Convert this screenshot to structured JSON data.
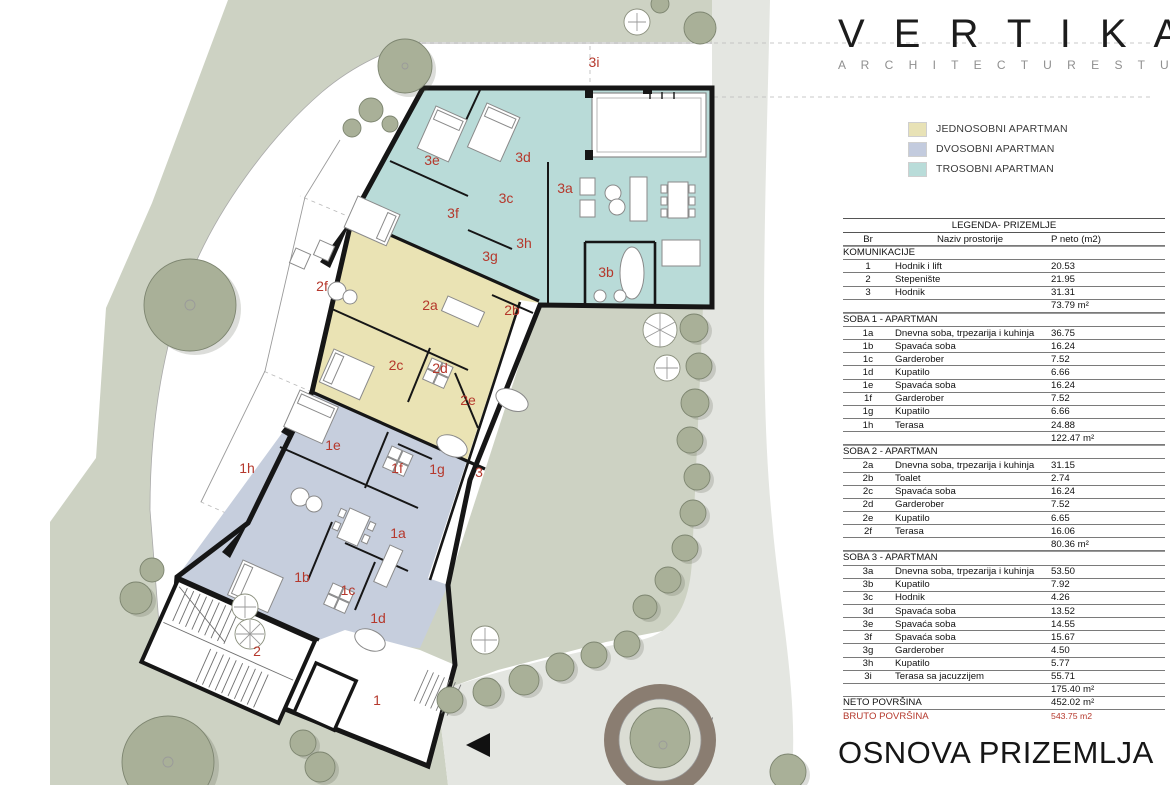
{
  "brand": {
    "name": "VERTIKALA",
    "display": "V E R T I K A L Λ",
    "subtitle": "A R C H I T E C T U R E   S T U D I O"
  },
  "legend": {
    "items": [
      {
        "label": "JEDNOSOBNI APARTMAN",
        "color": "#e8e2b6"
      },
      {
        "label": "DVOSOBNI APARTMAN",
        "color": "#c3cbde"
      },
      {
        "label": "TROSOBNI APARTMAN",
        "color": "#b9dcd9"
      }
    ]
  },
  "table": {
    "title": "LEGENDA- PRIZEMLJE",
    "columns": [
      "Br",
      "Naziv prostorije",
      "P neto (m2)"
    ],
    "sections": [
      {
        "name": "KOMUNIKACIJE",
        "rows": [
          [
            "1",
            "Hodnik i lift",
            "20.53"
          ],
          [
            "2",
            "Stepenište",
            "21.95"
          ],
          [
            "3",
            "Hodnik",
            "31.31"
          ]
        ],
        "subtotal": "73.79 m²"
      },
      {
        "name": "SOBA 1 - APARTMAN",
        "rows": [
          [
            "1a",
            "Dnevna soba, trpezarija i kuhinja",
            "36.75"
          ],
          [
            "1b",
            "Spavaća soba",
            "16.24"
          ],
          [
            "1c",
            "Garderober",
            "7.52"
          ],
          [
            "1d",
            "Kupatilo",
            "6.66"
          ],
          [
            "1e",
            "Spavaća soba",
            "16.24"
          ],
          [
            "1f",
            "Garderober",
            "7.52"
          ],
          [
            "1g",
            "Kupatilo",
            "6.66"
          ],
          [
            "1h",
            "Terasa",
            "24.88"
          ]
        ],
        "subtotal": "122.47 m²"
      },
      {
        "name": "SOBA 2 - APARTMAN",
        "rows": [
          [
            "2a",
            "Dnevna soba, trpezarija i kuhinja",
            "31.15"
          ],
          [
            "2b",
            "Toalet",
            "2.74"
          ],
          [
            "2c",
            "Spavaća soba",
            "16.24"
          ],
          [
            "2d",
            "Garderober",
            "7.52"
          ],
          [
            "2e",
            "Kupatilo",
            "6.65"
          ],
          [
            "2f",
            "Terasa",
            "16.06"
          ]
        ],
        "subtotal": "80.36 m²"
      },
      {
        "name": "SOBA 3 - APARTMAN",
        "rows": [
          [
            "3a",
            "Dnevna soba, trpezarija i kuhinja",
            "53.50"
          ],
          [
            "3b",
            "Kupatilo",
            "7.92"
          ],
          [
            "3c",
            "Hodnik",
            "4.26"
          ],
          [
            "3d",
            "Spavaća soba",
            "13.52"
          ],
          [
            "3e",
            "Spavaća soba",
            "14.55"
          ],
          [
            "3f",
            "Spavaća soba",
            "15.67"
          ],
          [
            "3g",
            "Garderober",
            "4.50"
          ],
          [
            "3h",
            "Kupatilo",
            "5.77"
          ],
          [
            "3i",
            "Terasa sa jacuzzijem",
            "55.71"
          ]
        ],
        "subtotal": "175.40 m²"
      }
    ],
    "totals": [
      {
        "label": "NETO POVRŠINA",
        "value": "452.02 m²",
        "style": "neto"
      },
      {
        "label": "BRUTO POVRŠINA",
        "value": "543.75 m2",
        "style": "bruto"
      }
    ]
  },
  "plan": {
    "title": "OSNOVA PRIZEMLJA",
    "label_color": "#b5382c",
    "colors": {
      "site": "#cdd2c3",
      "pavement": "#e4e6e1",
      "walkway": "#ffffff",
      "apartment1": "#c6cedd",
      "apartment2": "#eae3b4",
      "apartment3": "#b9dbd8",
      "wall": "#161616",
      "tree": "#a9b098",
      "planter_ring": "#8a7d71"
    },
    "rooms": [
      {
        "id": "3i",
        "x": 594,
        "y": 67
      },
      {
        "id": "3e",
        "x": 432,
        "y": 165
      },
      {
        "id": "3d",
        "x": 523,
        "y": 162
      },
      {
        "id": "3c",
        "x": 506,
        "y": 203
      },
      {
        "id": "3a",
        "x": 565,
        "y": 193
      },
      {
        "id": "3f",
        "x": 453,
        "y": 218
      },
      {
        "id": "3g",
        "x": 490,
        "y": 261
      },
      {
        "id": "3h",
        "x": 524,
        "y": 248
      },
      {
        "id": "3b",
        "x": 606,
        "y": 277
      },
      {
        "id": "2f",
        "x": 322,
        "y": 291
      },
      {
        "id": "2a",
        "x": 430,
        "y": 310
      },
      {
        "id": "2b",
        "x": 512,
        "y": 315
      },
      {
        "id": "2c",
        "x": 396,
        "y": 370
      },
      {
        "id": "2d",
        "x": 440,
        "y": 373
      },
      {
        "id": "2e",
        "x": 468,
        "y": 405
      },
      {
        "id": "1e",
        "x": 333,
        "y": 450
      },
      {
        "id": "1h",
        "x": 247,
        "y": 473
      },
      {
        "id": "1f",
        "x": 397,
        "y": 473
      },
      {
        "id": "1g",
        "x": 437,
        "y": 474
      },
      {
        "id": "3",
        "x": 479,
        "y": 477
      },
      {
        "id": "1a",
        "x": 398,
        "y": 538
      },
      {
        "id": "1b",
        "x": 302,
        "y": 582
      },
      {
        "id": "1c",
        "x": 348,
        "y": 595
      },
      {
        "id": "1d",
        "x": 378,
        "y": 623
      },
      {
        "id": "2",
        "x": 257,
        "y": 656
      },
      {
        "id": "1",
        "x": 377,
        "y": 705
      }
    ]
  }
}
